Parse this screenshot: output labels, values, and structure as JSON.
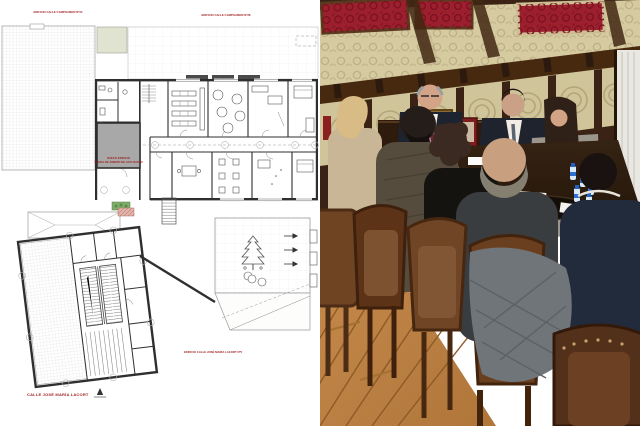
{
  "floor_plan": {
    "labels": {
      "top_left_building": "EDIFICIO CALLE CAMPOAMOR Nº24",
      "top_right_building": "EDIFICIO CALLE CAMPOAMOR Nº28",
      "core_note_line1": "HUECO EDIFICIO",
      "core_note_line2": "FUERA DE ÁMBITO DE ACTUACIÓN",
      "bottom_building": "EDIFICIO CALLE JOSÉ MARÍA LACORT Nº5",
      "street": "CALLE JOSÉ MARÍA LACORT"
    },
    "colors": {
      "annotation_red": "#9e1b1b",
      "wall_dark": "#2f2f2f",
      "core_gray": "#a8a8a8",
      "green_area": "#dfe3cf",
      "planter_green": "#7fae6a",
      "demolition_pink": "#e0b4aa"
    }
  },
  "photo": {
    "colors": {
      "damask_red": "#9c1f2e",
      "plaster_cream": "#d6cba0",
      "wood_dark": "#3a2315",
      "rail_wood": "#46290f",
      "table_wood": "#2e1d0e",
      "floor_wood": "#bc8044",
      "curtain_white": "#e9e7e1",
      "bottle_blue": "#1f63c8",
      "folder_blue": "#1b7fe0"
    }
  }
}
